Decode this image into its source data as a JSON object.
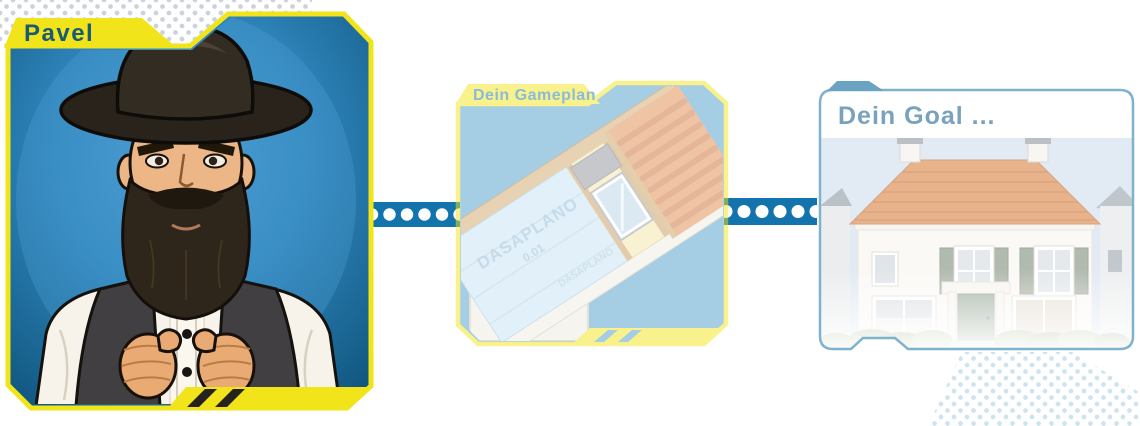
{
  "panels": {
    "pavel": {
      "tab_label": "Pavel",
      "illustration": "pavel-portrait-man-with-hat-and-beard"
    },
    "gameplan": {
      "tab_label": "Dein Gameplan",
      "membrane_brand": "DASAPLANO",
      "membrane_grade": "0.01",
      "illustration": "roof-insulation-cutaway"
    },
    "goal": {
      "title": "Dein Goal ...",
      "illustration": "white-house-with-orange-tiled-roof"
    }
  },
  "connectors": [
    {
      "style": "blue-bar-white-dots"
    },
    {
      "style": "blue-bar-white-dots"
    }
  ],
  "colors": {
    "accent_yellow": "#F2E41B",
    "panel_blue": "#2B84BB",
    "panel_blue_deep": "#11567F",
    "connector_blue": "#1374AD",
    "pavel_tab_text": "#1A5A74",
    "gameplan_tab_text": "#1779B5",
    "gameplan_bg_blue": "#4E9DC8",
    "goal_title_text": "#7BA2BC",
    "goal_card_border": "#7FB2CD",
    "goal_tab_fill": "#6BA3C2",
    "membrane_blue": "#C6E4F5",
    "roof_tile_orange": "#D9813F",
    "shutter_green": "#7D8C7B",
    "door_green": "#70876F",
    "dot_gray": "#C9D2DD",
    "dot_blue": "#CDE4F0"
  }
}
